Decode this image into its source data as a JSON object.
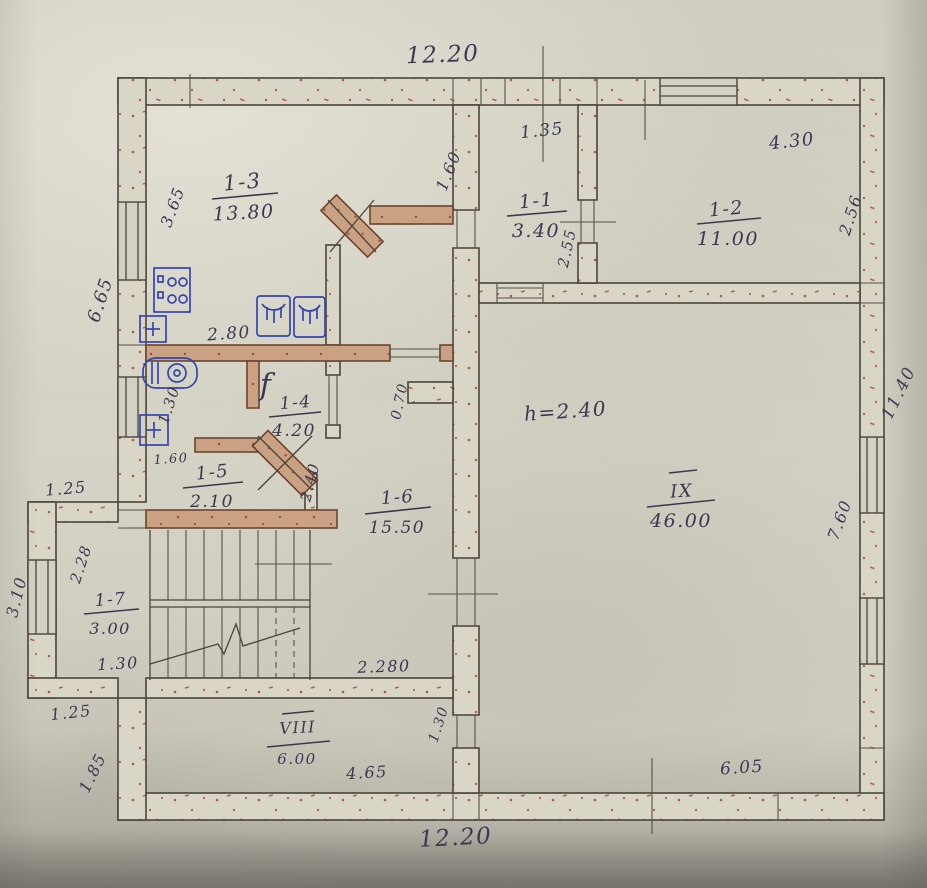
{
  "photo": {
    "type": "scanned hand-drawn apartment floor plan"
  },
  "rooms": {
    "r13": {
      "id": "1-3",
      "area": "13.80"
    },
    "r11": {
      "id": "1-1",
      "area": "3.40"
    },
    "r12": {
      "id": "1-2",
      "area": "11.00"
    },
    "r14": {
      "id": "1-4",
      "area": "4.20"
    },
    "r15": {
      "id": "1-5",
      "area": "2.10"
    },
    "r16": {
      "id": "1-6",
      "area": "15.50"
    },
    "r17": {
      "id": "1-7",
      "area": "3.00"
    },
    "r8": {
      "id": "VIII",
      "area": "6.00"
    },
    "r9": {
      "id": "IX",
      "area": "46.00"
    }
  },
  "dims": {
    "top": "12.20",
    "bottom": "12.20",
    "right_outer": "11.40",
    "d135": "1.35",
    "d430": "4.30",
    "d256": "2.56",
    "d160": "1.60",
    "d365": "3.65",
    "d665": "6.65",
    "d255": "2.55",
    "d280": "2.80",
    "d130wc": "1.30",
    "d070": "0.70",
    "d160b": "1.60",
    "d240": "2.40",
    "d125a": "1.25",
    "d228": "2.28",
    "d310": "3.10",
    "d130st": "1.30",
    "d2280": "2.280",
    "d125b": "1.25",
    "d185": "1.85",
    "d130h": "1.30",
    "d465": "4.65",
    "d605": "6.05",
    "d760": "7.60"
  },
  "notes": {
    "height": "h=2.40"
  },
  "fixtures": {
    "faucet_label": "f"
  },
  "colors": {
    "paper": "#d2cfc0",
    "pencil": "#4b443b",
    "ink": "#3c3852",
    "fixture_blue": "#3545b0",
    "stipple_red": "#a84434",
    "partition_tan": "#cba183"
  }
}
